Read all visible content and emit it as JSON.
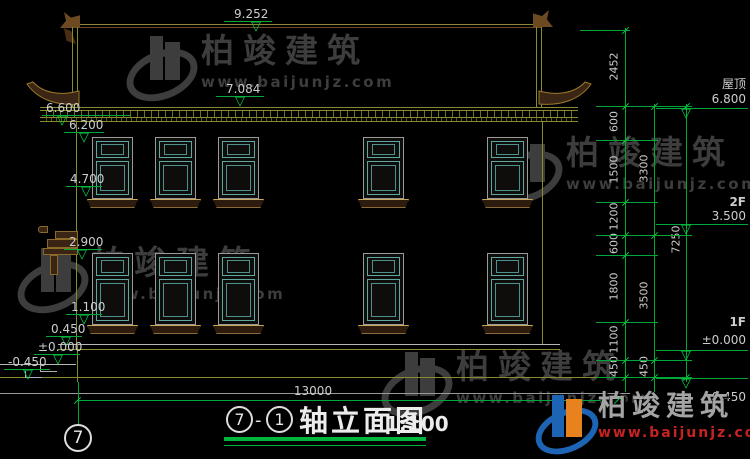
{
  "levels_left": {
    "ridge": "9.252",
    "upper_eave": "7.084",
    "eave": "6.600",
    "wall_top": "6.200",
    "f2_sill": "4.700",
    "f1_window_top": "2.900",
    "f1_window_sill": "1.100",
    "plinth_top": "0.450",
    "floor_zero": "±0.000",
    "ground": "-0.450"
  },
  "levels_right": {
    "roof_label": "屋顶",
    "roof": "6.800",
    "f2_label": "2F",
    "f2": "3.500",
    "f1_label": "1F",
    "f1": "±0.000",
    "ground": "0.450"
  },
  "vdims": {
    "seg_2452": "2452",
    "seg_600a": "600",
    "seg_1500": "1500",
    "seg_1200": "1200",
    "seg_600b": "600",
    "seg_1800": "1800",
    "seg_1100": "1100",
    "seg_450a": "450",
    "sub_3300": "3300",
    "sub_3500": "3500",
    "sub_450": "450",
    "total_7250": "7250"
  },
  "hdims": {
    "total_width": "13000"
  },
  "title": {
    "bubble_start": "7",
    "separator": "-",
    "bubble_end": "1",
    "name": "轴立面图",
    "scale": "1:100"
  },
  "axis": {
    "bubble_label": "7"
  },
  "watermark": {
    "brand": "柏竣建筑",
    "site": "www.baijunjz.com"
  },
  "logo": {
    "brand": "柏竣建筑",
    "site": "www.baijunjz.com"
  },
  "colors": {
    "dim_green": "#00a838",
    "roof_yellow": "#8a8a2e",
    "window_teal": "#5fa8a2",
    "watermark_gray": "#3d3d3d",
    "logo_blue": "#1e64b4",
    "logo_orange": "#e8821e",
    "site_red": "#c62222"
  }
}
